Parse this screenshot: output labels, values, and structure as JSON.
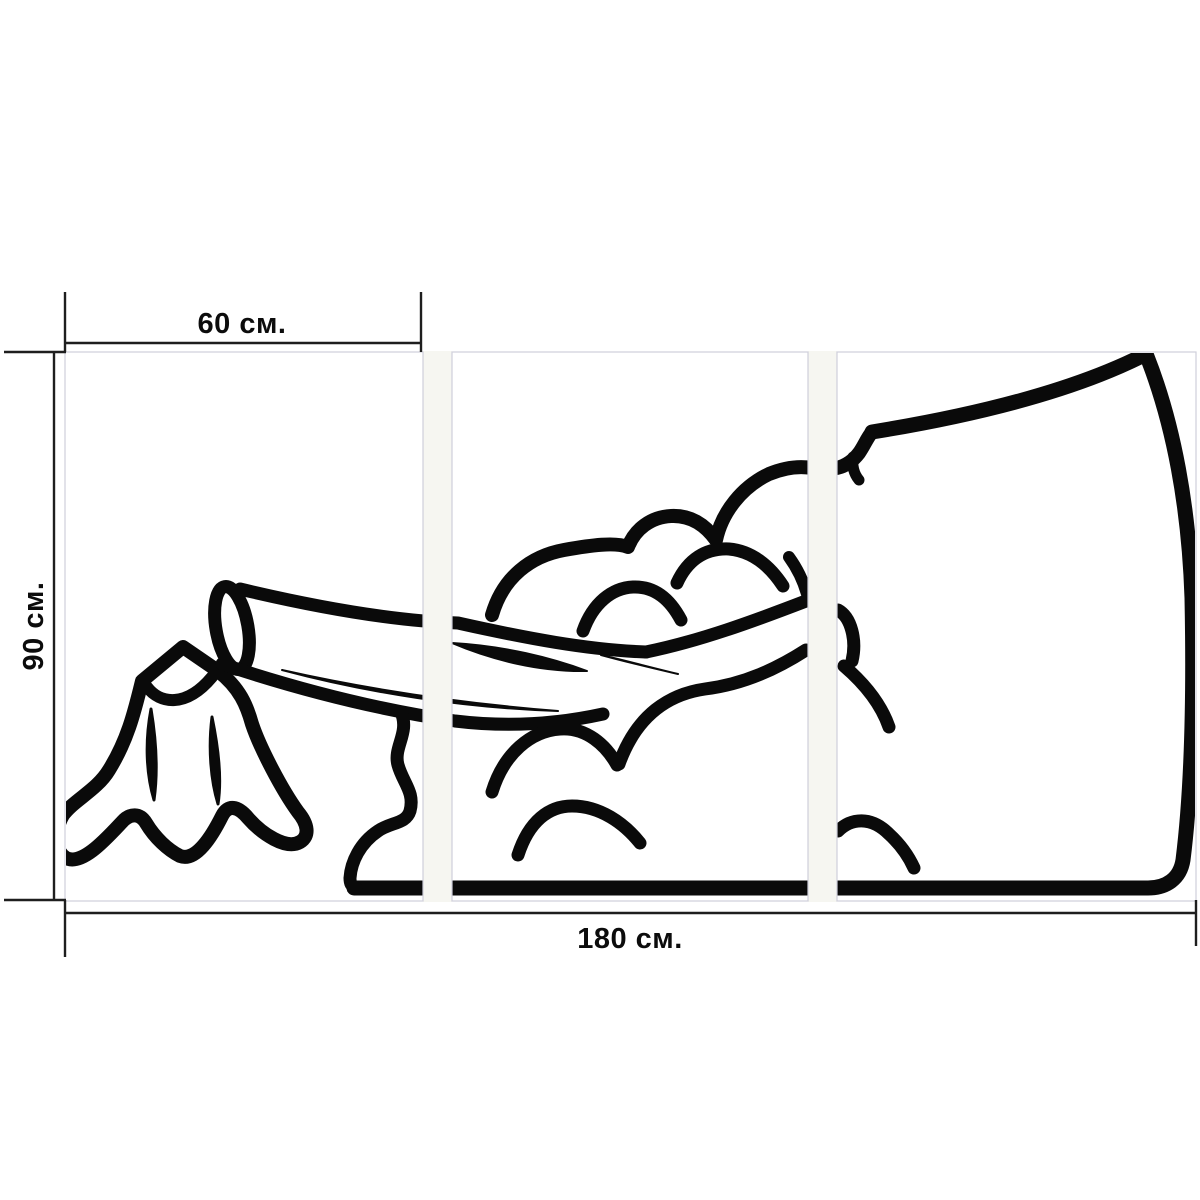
{
  "artwork": {
    "description": "Triptych wall-art mockup: black outline cartoon of an axe head splitting a log over a tree stump with dust clouds, across three vertical panels",
    "panel_count": 3,
    "labels": {
      "panel_width": "60 см.",
      "height": "90 см.",
      "total_width": "180 см."
    },
    "colors": {
      "background": "#ffffff",
      "line_art": "#0a0a0a",
      "dimension_lines": "#1e1e1e",
      "panel_border": "#cfcfda",
      "panel_gap": "#f6f6f1"
    }
  }
}
